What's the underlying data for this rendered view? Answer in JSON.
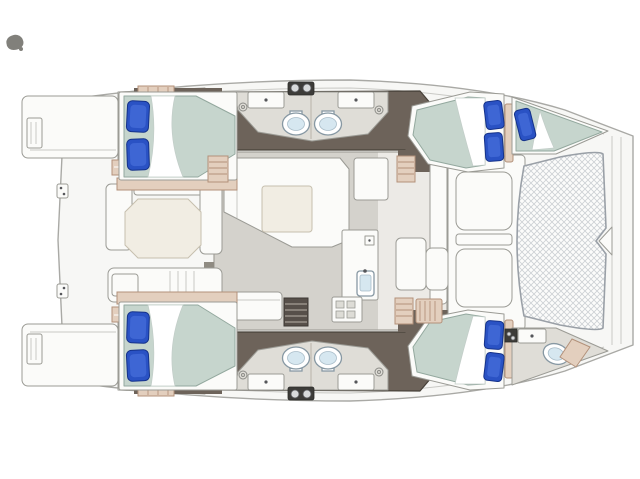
{
  "diagram": {
    "type": "boat-floor-plan",
    "subject": "Catamaran interior layout plan, top view, bow pointing right",
    "components": [
      "stern-platforms",
      "transom-steps",
      "aft-cockpit",
      "cockpit-table",
      "saloon",
      "u-sofa",
      "saloon-table",
      "galley",
      "galley-sink",
      "stove",
      "hull-cabins",
      "double-beds",
      "forepeak-berth",
      "bathrooms",
      "toilets",
      "vanity-sinks",
      "shower-drains",
      "companionway-steps",
      "forward-cockpit-sunpads",
      "trampoline",
      "bow-crossbeam",
      "bowsprit-bracket"
    ],
    "counts": {
      "double_beds": 4,
      "forepeak_single_berths": 1,
      "pillows": 9,
      "toilets": 5,
      "bathroom_sinks": 4,
      "bow_bathroom_sinks": 1,
      "galley_sinks": 1,
      "stove_burners": 4,
      "cockpit_tables": 1,
      "saloon_tables": 1,
      "trampolines": 1,
      "transom_platforms": 2,
      "companionway_steps": 4
    }
  },
  "colors": {
    "hull": "#f7f7f5",
    "hull_stroke": "#a9a9a5",
    "deck_line": "#c9c9c5",
    "floor_dark": "#6d635a",
    "floor_dark_stroke": "#474139",
    "floor_saloon": "#d4d2cc",
    "floor_galley": "#eceae6",
    "floor_bath": "#dfddd7",
    "white_f": "#fbfbf9",
    "furn_stroke": "#9b9b95",
    "tan": "#e3cfbe",
    "tan_stroke": "#b3917a",
    "mattress": "#c6d5cd",
    "mattress_stroke": "#93a89e",
    "sheet": "#ffffff",
    "pillow": "#2a52c4",
    "pillow_hi": "#4a71dd",
    "pillow_stroke": "#15328a",
    "table": "#f1ede3",
    "table_stroke": "#c6bfae",
    "toilet_stroke": "#8798a3",
    "toilet_inner": "#d6e7f0",
    "tramp_frame_stroke": "#9aa0a7",
    "dark_box": "#3d3c39",
    "dark_steps": "#57504a",
    "smudge": "#81807b"
  }
}
